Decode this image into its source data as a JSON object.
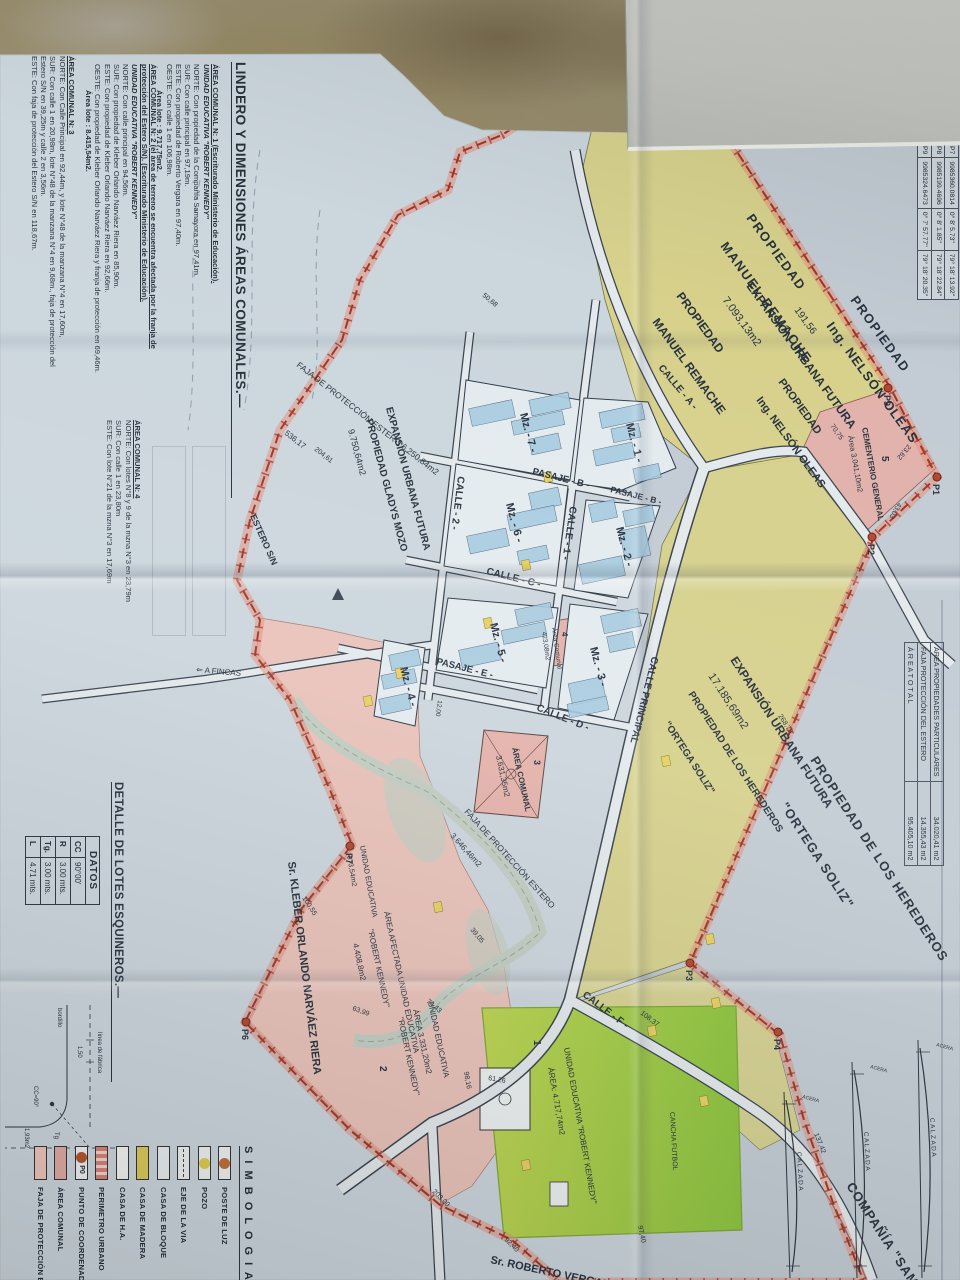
{
  "palette": {
    "paper": "#ccd6dd",
    "paper2": "#c3ced8",
    "dirt": "#8d7e62",
    "yellow": "#d9d289",
    "pink": "#e6b7ae",
    "pinkzone": "#e9c3ba",
    "green1": "#8cc43e",
    "green2": "#bcd551",
    "lotblue": "#a7cbe0",
    "casa": "#e6d163",
    "road": "#e3e9ec",
    "red": "#a33427",
    "ink": "#27313d"
  },
  "notes": {
    "title": "LINDERO Y DIMENSIONES ÁREAS COMUNALES.—",
    "blocks": [
      {
        "heading": "ÁREA COMUNAL N: 1 (Escriturado Ministerio de Educación).",
        "sub": "UNIDAD EDUCATIVA \"ROBERT KENNEDY\"",
        "lines": [
          "NORTE: Con propiedad de la Compañía Samayora en 97,41m.",
          "SUR:  Con calle principal en 97,19m.",
          "ESTE:  Con propiedad de Roberto Vergara en 97,40m.",
          "OESTE: Con calle 1 en 106,98m."
        ],
        "area": "Área lote : 9.717,75m2."
      },
      {
        "heading": "ÁREA COMUNAL N: 2 (el área de terreno se encuentra afectada por la franja de protección del Estero S/N).  (Escriturado Ministerio de Educación).",
        "sub": "UNIDAD EDUCATIVA \"ROBERT KENNEDY\"",
        "lines": [
          "NORTE: Con calle principal en 94,56m.",
          "SUR:  Con propiedad de Kleber Orlando Narváez Riera en 85,90m.",
          "ESTE:  Con propiedad de Kleber Orlando Narváez Riera en 92,66m.",
          "OESTE: Con propiedad de Kleber Orlando Narváez Riera y franja de protección en 69,46m."
        ],
        "area": "Área lote : 8.415,54m2."
      },
      {
        "heading": "ÁREA COMUNAL N: 3",
        "sub": "",
        "lines": [
          "NORTE: Con Calle Principal en 92,44m, y lote N°48 de la manzana N°4 en 17,60m,",
          "SUR:  Con calle 1 en 20,98m, lote N°48 de la manzana N°4 en 9,68m., faja de protección del Estero S/N en 39,25m y calle 2 en 3,56m.",
          "ESTE:  Con faja de protección del Estero S/N en 118,67m."
        ],
        "area": ""
      },
      {
        "heading": "ÁREA COMUNAL N: 4",
        "sub": "",
        "lines": [
          "NORTE: Con lotes N°8 y 9 de la mzna N°3 en 23,79m",
          "SUR:  Con calle 1 en 23,80m",
          "ESTE:  Con lote N°21 de la mzna N°3 en 17,69m"
        ],
        "area": ""
      }
    ]
  },
  "detalle": {
    "title": "DETALLE DE LOTES ESQUINEROS.—",
    "datos": {
      "header": "DATOS",
      "rows": [
        [
          "CC",
          "90°00'"
        ],
        [
          "R",
          "3.00 mts."
        ],
        [
          "Tg.",
          "3.00 mts."
        ],
        [
          "L",
          "4.71 mts."
        ]
      ]
    },
    "drawing": {
      "linea": "línea de fábrica",
      "bordillo": "bordillo",
      "dim": "1,50",
      "tg": "Tg",
      "area": "1,93m2",
      "cc": "CC=90°"
    }
  },
  "simbologia": {
    "title": "S I M B O L O G I A",
    "items": [
      {
        "label": "POSTE DE LUZ",
        "type": "circle",
        "color": "#bf6f3c"
      },
      {
        "label": "POZO",
        "type": "circle",
        "color": "#dfcb50"
      },
      {
        "label": "EJE DE LA VIA",
        "type": "dashline",
        "color": "#eef1f2"
      },
      {
        "label": "CASA DE BLOQUE",
        "type": "rect",
        "color": "#e8edf0"
      },
      {
        "label": "CASA DE MADERA",
        "type": "rect",
        "color": "#ddc95a"
      },
      {
        "label": "CASA DE H.A.",
        "type": "rect",
        "color": "#f2f4f2"
      },
      {
        "label": "PERIMETRO URBANO",
        "type": "hatch",
        "color": "#d98176"
      },
      {
        "label": "PUNTO DE COORDENADAS",
        "type": "point",
        "color": "#b4552e",
        "text": "P0"
      },
      {
        "label": "ÁREA COMUNAL",
        "type": "rect",
        "color": "#e2aaa4"
      },
      {
        "label": "FAJA DE PROTECCIÓN ESTERO",
        "type": "rect",
        "color": "#eec6bb"
      }
    ]
  },
  "coord_table": {
    "rows": [
      [
        "P7",
        "9985360.0814",
        "0° 8' 5.73''",
        "79° 18' 13.92''"
      ],
      [
        "P8",
        "9985199.4696",
        "0° 8' 1.85''",
        "79° 18' 22.84''"
      ],
      [
        "P9",
        "9985324.6473",
        "0° 7' 57.77''",
        "79° 18' 20.35''"
      ]
    ]
  },
  "area_table": {
    "rows": [
      [
        "ÁREA PROPIEDADES PARTICULARES",
        "34.020,41 m2"
      ],
      [
        "FAJA PROTECCIÓN DEL ESTERO",
        "14.355,43 m2"
      ],
      [
        "Á R E A   T O T A L",
        "95.405,10 m2"
      ]
    ]
  },
  "sections": [
    {
      "road": "C A L Z A D A",
      "side": "ACERA"
    },
    {
      "road": "C A L Z A D A",
      "side": "ACERA"
    },
    {
      "road": "C A L Z A D A",
      "side": "ACERA"
    }
  ],
  "map": {
    "labels": [
      {
        "t": "PROPIEDAD",
        "x": 218,
        "y": 214,
        "r": -36,
        "s": 13,
        "b": 1,
        "ls": 1.5
      },
      {
        "t": "MANUEL REMACHE",
        "x": 246,
        "y": 240,
        "r": -36,
        "s": 13,
        "b": 1,
        "ls": 1.5
      },
      {
        "t": "PROPIEDAD",
        "x": 300,
        "y": 110,
        "r": -36,
        "s": 13,
        "b": 1,
        "ls": 1.5
      },
      {
        "t": "Ing. NELSÓN OLEAS",
        "x": 326,
        "y": 134,
        "r": -36,
        "s": 13,
        "b": 1,
        "ls": 1
      },
      {
        "t": "191,56",
        "x": 310,
        "y": 166,
        "r": -36,
        "s": 10
      },
      {
        "t": "EXPANSIÓN URBANA FUTURA",
        "x": 286,
        "y": 214,
        "r": -36,
        "s": 12,
        "b": 1
      },
      {
        "t": "7.093,13m2",
        "x": 300,
        "y": 238,
        "r": -36,
        "s": 11
      },
      {
        "t": "PROPIEDAD",
        "x": 382,
        "y": 182,
        "r": -36,
        "s": 11,
        "b": 1
      },
      {
        "t": "Ing. NELSÓN OLEAS",
        "x": 400,
        "y": 204,
        "r": -36,
        "s": 11,
        "b": 1
      },
      {
        "t": "PROPIEDAD",
        "x": 296,
        "y": 284,
        "r": -36,
        "s": 12,
        "b": 1
      },
      {
        "t": "MANUEL REMACHE",
        "x": 322,
        "y": 308,
        "r": -36,
        "s": 12,
        "b": 1
      },
      {
        "t": "PROPIEDAD DE LOS HEREDEROS",
        "x": 760,
        "y": 150,
        "r": -33,
        "s": 13,
        "b": 1,
        "ls": 1
      },
      {
        "t": "\"ORTEGA SOLIZ\"",
        "x": 806,
        "y": 180,
        "r": -33,
        "s": 13,
        "b": 1,
        "ls": 1
      },
      {
        "t": "EXPANSIÓN URBANA FUTURA",
        "x": 660,
        "y": 230,
        "r": -33,
        "s": 12,
        "b": 1
      },
      {
        "t": "17.185,69m2",
        "x": 676,
        "y": 252,
        "r": -33,
        "s": 11
      },
      {
        "t": "PROPIEDAD DE LOS HEREDEROS",
        "x": 694,
        "y": 272,
        "r": -33,
        "s": 10,
        "b": 1
      },
      {
        "t": "\"ORTEGA SOLIZ\"",
        "x": 724,
        "y": 296,
        "r": -33,
        "s": 10,
        "b": 1
      },
      {
        "t": "COMPAÑÍA \"SAMAYORA\"",
        "x": 1186,
        "y": 114,
        "r": -33,
        "s": 13,
        "b": 1,
        "ls": 1
      },
      {
        "t": "Sr. KLEBER ORLANDO NARVÁEZ RIERA",
        "x": 862,
        "y": 672,
        "r": -7,
        "s": 11,
        "b": 1
      },
      {
        "t": "Sr. ROBERTO VERGARA",
        "x": 1263,
        "y": 470,
        "r": -78,
        "s": 11,
        "b": 1
      },
      {
        "t": "CEMENTERIO GENERAL",
        "x": 428,
        "y": 98,
        "r": -10,
        "s": 8,
        "b": 1
      },
      {
        "t": "Área 3.041,10m2",
        "x": 436,
        "y": 112,
        "r": -10,
        "s": 7.5
      },
      {
        "t": "5",
        "x": 456,
        "y": 78,
        "r": 0,
        "s": 10,
        "b": 1
      },
      {
        "t": "CALLE  - A -",
        "x": 368,
        "y": 302,
        "r": -40,
        "s": 10,
        "b": 1
      },
      {
        "t": "PASAJE  - B -",
        "x": 474,
        "y": 428,
        "r": -76,
        "s": 9.5,
        "b": 1
      },
      {
        "t": "PASAJE  - B -",
        "x": 492,
        "y": 350,
        "r": -76,
        "s": 8.5,
        "b": 1
      },
      {
        "t": "CALLE  - 1 -",
        "x": 506,
        "y": 390,
        "r": 8,
        "s": 10,
        "b": 1
      },
      {
        "t": "CALLE  - 2 -",
        "x": 476,
        "y": 502,
        "r": 7,
        "s": 10,
        "b": 1
      },
      {
        "t": "CALLE  - C -",
        "x": 574,
        "y": 474,
        "r": -76,
        "s": 10,
        "b": 1
      },
      {
        "t": "PASAJE  - E -",
        "x": 664,
        "y": 524,
        "r": -76,
        "s": 9.5,
        "b": 1
      },
      {
        "t": "CALLE  - D -",
        "x": 710,
        "y": 424,
        "r": -68,
        "s": 10,
        "b": 1
      },
      {
        "t": "CALLE PRINCIPAL",
        "x": 656,
        "y": 308,
        "r": 14,
        "s": 10,
        "b": 1
      },
      {
        "t": "CALLE  - F -",
        "x": 996,
        "y": 378,
        "r": -53,
        "s": 10,
        "b": 1
      },
      {
        "t": "ÁREA COMUNAL",
        "x": 748,
        "y": 448,
        "r": -12,
        "s": 8,
        "b": 1
      },
      {
        "t": "3.631,35m2",
        "x": 756,
        "y": 464,
        "r": -12,
        "s": 8
      },
      {
        "t": "3",
        "x": 760,
        "y": 426,
        "r": 0,
        "s": 9,
        "b": 1
      },
      {
        "t": "Área Comunal",
        "x": 628,
        "y": 408,
        "r": -8,
        "s": 6.5
      },
      {
        "t": "423,08m2",
        "x": 632,
        "y": 418,
        "r": -8,
        "s": 6.5
      },
      {
        "t": "4",
        "x": 632,
        "y": 398,
        "r": 0,
        "s": 8,
        "b": 1
      },
      {
        "t": "EXPANSIÓN URBANA FUTURA",
        "x": 408,
        "y": 574,
        "r": -15,
        "s": 10,
        "b": 1
      },
      {
        "t": "PROPIEDAD GLADYS MOZO",
        "x": 420,
        "y": 594,
        "r": -15,
        "s": 10,
        "b": 1
      },
      {
        "t": "9.750,64m2",
        "x": 430,
        "y": 612,
        "r": -15,
        "s": 9
      },
      {
        "t": "FAJA DE PROTECCIÓN ESTERO 6.250,84m2",
        "x": 366,
        "y": 664,
        "r": -52,
        "s": 8.5
      },
      {
        "t": "ESTERO S/N",
        "x": 516,
        "y": 710,
        "r": -24,
        "s": 9,
        "b": 1
      },
      {
        "t": "FAJA DE PROTECCIÓN ESTERO",
        "x": 812,
        "y": 496,
        "r": -42,
        "s": 8.5
      },
      {
        "t": "3.646,46m2",
        "x": 836,
        "y": 510,
        "r": -42,
        "s": 8
      },
      {
        "t": "UNIDAD EDUCATIVA",
        "x": 846,
        "y": 600,
        "r": -10,
        "s": 7.5
      },
      {
        "t": "673,54m2",
        "x": 856,
        "y": 613,
        "r": -10,
        "s": 7
      },
      {
        "t": "ÁREA AFECTADA UNIDAD EDUCATIVA",
        "x": 912,
        "y": 576,
        "r": -12,
        "s": 8
      },
      {
        "t": "\"ROBERT KENNEDY\"",
        "x": 930,
        "y": 592,
        "r": -12,
        "s": 8
      },
      {
        "t": "4.408,8m2",
        "x": 944,
        "y": 607,
        "r": -12,
        "s": 8
      },
      {
        "t": "UNIDAD EDUCATIVA",
        "x": 1002,
        "y": 532,
        "r": -12,
        "s": 8
      },
      {
        "t": "ÁREA 3.331,20m2",
        "x": 1010,
        "y": 547,
        "r": -12,
        "s": 8
      },
      {
        "t": "\"ROBERT KENNEDY\"",
        "x": 1018,
        "y": 562,
        "r": -12,
        "s": 8
      },
      {
        "t": "2",
        "x": 1066,
        "y": 580,
        "r": 0,
        "s": 10,
        "b": 1
      },
      {
        "t": "UNIDAD EDUCATIVA \"ROBERT KENNEDY\"",
        "x": 1048,
        "y": 396,
        "r": -10,
        "s": 8
      },
      {
        "t": "ÁREA: 4.717,74m2",
        "x": 1068,
        "y": 412,
        "r": -10,
        "s": 8
      },
      {
        "t": "1",
        "x": 1040,
        "y": 426,
        "r": 0,
        "s": 10,
        "b": 1
      },
      {
        "t": "CANCHA FUTBOL",
        "x": 1112,
        "y": 290,
        "r": -3,
        "s": 7
      },
      {
        "t": "⇐ A FINCAS",
        "x": 672,
        "y": 764,
        "r": -85,
        "s": 8
      },
      {
        "t": "Mz. - 1 -",
        "x": 424,
        "y": 334,
        "r": -15,
        "s": 11,
        "b": 1
      },
      {
        "t": "Mz. - 2 -",
        "x": 528,
        "y": 344,
        "r": -15,
        "s": 11,
        "b": 1
      },
      {
        "t": "Mz. - 3 -",
        "x": 648,
        "y": 370,
        "r": -15,
        "s": 11,
        "b": 1
      },
      {
        "t": "Mz. - 7 -",
        "x": 414,
        "y": 440,
        "r": -15,
        "s": 11,
        "b": 1
      },
      {
        "t": "Mz. - 6 -",
        "x": 504,
        "y": 454,
        "r": -15,
        "s": 11,
        "b": 1
      },
      {
        "t": "Mz. - 5 -",
        "x": 624,
        "y": 470,
        "r": -15,
        "s": 11,
        "b": 1
      },
      {
        "t": "Mz. - 4 -",
        "x": 668,
        "y": 560,
        "r": -15,
        "s": 11,
        "b": 1
      },
      {
        "t": "50,68",
        "x": 296,
        "y": 478,
        "r": -50,
        "s": 7
      },
      {
        "t": "536,17",
        "x": 434,
        "y": 676,
        "r": -52,
        "s": 8
      },
      {
        "t": "204,61",
        "x": 450,
        "y": 646,
        "r": -52,
        "s": 7
      },
      {
        "t": "100,55",
        "x": 898,
        "y": 658,
        "r": -33,
        "s": 7
      },
      {
        "t": "108,37",
        "x": 1014,
        "y": 320,
        "r": -53,
        "s": 7
      },
      {
        "t": "137,42",
        "x": 1134,
        "y": 146,
        "r": -22,
        "s": 7
      },
      {
        "t": "203,00",
        "x": 1192,
        "y": 528,
        "r": -45,
        "s": 7
      },
      {
        "t": "92,40",
        "x": 1240,
        "y": 456,
        "r": -45,
        "s": 7
      },
      {
        "t": "70,75",
        "x": 426,
        "y": 130,
        "r": -35,
        "s": 7
      },
      {
        "t": "23,62",
        "x": 444,
        "y": 52,
        "r": 40,
        "s": 7
      },
      {
        "t": "43,03",
        "x": 502,
        "y": 62,
        "r": 30,
        "s": 7
      },
      {
        "t": "268,73",
        "x": 716,
        "y": 182,
        "r": -33,
        "s": 7
      },
      {
        "t": "39,05",
        "x": 930,
        "y": 490,
        "r": -40,
        "s": 7
      },
      {
        "t": "74,43",
        "x": 1002,
        "y": 534,
        "r": -50,
        "s": 7
      },
      {
        "t": "63,99",
        "x": 1010,
        "y": 608,
        "r": -70,
        "s": 7
      },
      {
        "t": "98,16",
        "x": 1072,
        "y": 496,
        "r": -10,
        "s": 7
      },
      {
        "t": "61,26",
        "x": 1080,
        "y": 472,
        "r": -80,
        "s": 7
      },
      {
        "t": "97,40",
        "x": 1226,
        "y": 322,
        "r": -12,
        "s": 7
      },
      {
        "t": "12,00",
        "x": 700,
        "y": 522,
        "r": 8,
        "s": 6.5
      }
    ],
    "points": [
      {
        "id": "P1",
        "x": 477,
        "y": 23
      },
      {
        "id": "P2",
        "x": 537,
        "y": 88
      },
      {
        "id": "P3",
        "x": 963,
        "y": 270
      },
      {
        "id": "P4",
        "x": 1032,
        "y": 182
      },
      {
        "id": "P6",
        "x": 1022,
        "y": 714
      },
      {
        "id": "P7",
        "x": 846,
        "y": 610
      },
      {
        "id": "P9",
        "x": 388,
        "y": 72
      },
      {
        "id": "",
        "x": 18,
        "y": 310
      }
    ],
    "casas": [
      [
        756,
        290
      ],
      [
        934,
        246
      ],
      [
        998,
        240
      ],
      [
        1026,
        304
      ],
      [
        1096,
        252
      ],
      [
        696,
        588
      ],
      [
        668,
        556
      ],
      [
        902,
        518
      ],
      [
        618,
        468
      ],
      [
        560,
        430
      ],
      [
        472,
        408
      ],
      [
        1160,
        430
      ]
    ],
    "lots": [
      [
        408,
        316,
        16,
        44
      ],
      [
        426,
        320,
        14,
        28
      ],
      [
        446,
        326,
        16,
        40
      ],
      [
        466,
        300,
        14,
        26
      ],
      [
        508,
        306,
        16,
        30
      ],
      [
        528,
        312,
        30,
        26
      ],
      [
        560,
        336,
        20,
        44
      ],
      [
        502,
        344,
        18,
        26
      ],
      [
        612,
        320,
        18,
        38
      ],
      [
        634,
        326,
        16,
        26
      ],
      [
        680,
        356,
        22,
        34
      ],
      [
        700,
        352,
        14,
        40
      ],
      [
        396,
        390,
        16,
        40
      ],
      [
        416,
        396,
        14,
        52
      ],
      [
        404,
        446,
        18,
        44
      ],
      [
        436,
        400,
        16,
        30
      ],
      [
        490,
        400,
        18,
        30
      ],
      [
        510,
        404,
        16,
        48
      ],
      [
        532,
        452,
        18,
        40
      ],
      [
        548,
        412,
        14,
        30
      ],
      [
        606,
        408,
        16,
        36
      ],
      [
        626,
        414,
        14,
        44
      ],
      [
        646,
        460,
        18,
        40
      ],
      [
        652,
        540,
        16,
        30
      ],
      [
        672,
        544,
        14,
        34
      ],
      [
        696,
        550,
        16,
        30
      ]
    ]
  }
}
